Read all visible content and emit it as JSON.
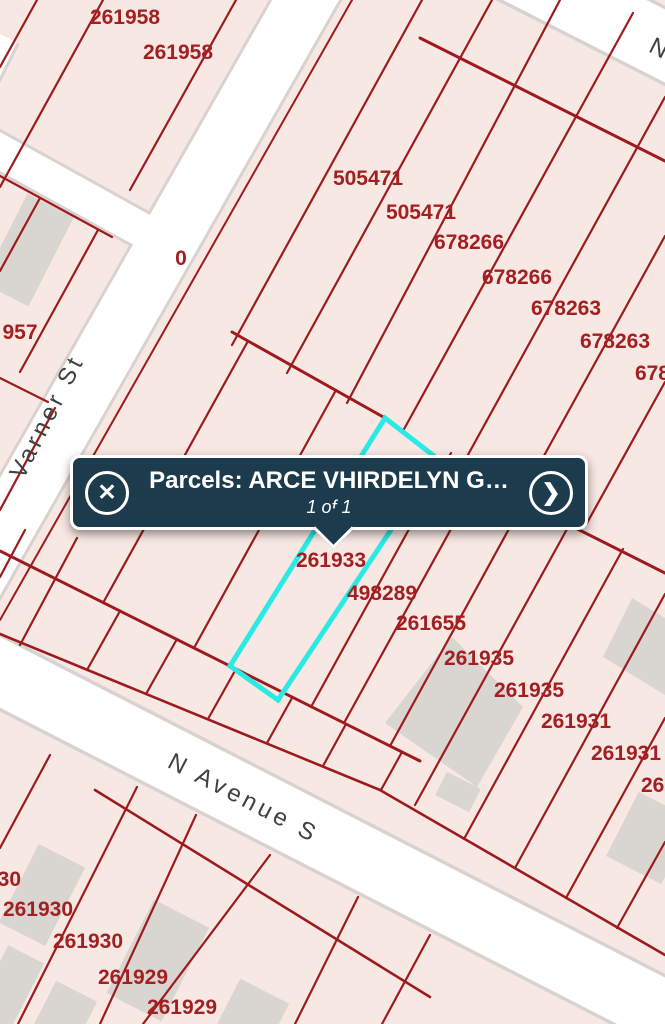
{
  "map": {
    "background_color": "#f8e8e4",
    "parcel_line_color": "#9d1b1e",
    "parcel_label_color": "#a32022",
    "highlight_color": "#2be9e3",
    "street_fill": "#ffffff",
    "street_casing": "#d8d3d0",
    "building_fill": "#d9d5d0",
    "street_label_color": "#3f4040",
    "parcel_labels": [
      {
        "text": "261958",
        "x": 125,
        "y": 24
      },
      {
        "text": "261958",
        "x": 178,
        "y": 59
      },
      {
        "text": "0",
        "x": 181,
        "y": 265
      },
      {
        "text": "957",
        "x": 20,
        "y": 339
      },
      {
        "text": "505471",
        "x": 368,
        "y": 185
      },
      {
        "text": "505471",
        "x": 421,
        "y": 219
      },
      {
        "text": "678266",
        "x": 469,
        "y": 249
      },
      {
        "text": "678266",
        "x": 517,
        "y": 284
      },
      {
        "text": "678263",
        "x": 566,
        "y": 315
      },
      {
        "text": "678263",
        "x": 615,
        "y": 348
      },
      {
        "text": "678263",
        "x": 670,
        "y": 380
      },
      {
        "text": "261933",
        "x": 331,
        "y": 567
      },
      {
        "text": "498289",
        "x": 382,
        "y": 600
      },
      {
        "text": "261655",
        "x": 431,
        "y": 630
      },
      {
        "text": "261935",
        "x": 479,
        "y": 665
      },
      {
        "text": "261935",
        "x": 529,
        "y": 697
      },
      {
        "text": "261931",
        "x": 576,
        "y": 728
      },
      {
        "text": "261931",
        "x": 626,
        "y": 760
      },
      {
        "text": "261931",
        "x": 676,
        "y": 792
      },
      {
        "text": "261930",
        "x": -14,
        "y": 886
      },
      {
        "text": "261930",
        "x": 38,
        "y": 916
      },
      {
        "text": "261930",
        "x": 88,
        "y": 948
      },
      {
        "text": "261929",
        "x": 133,
        "y": 984
      },
      {
        "text": "261929",
        "x": 182,
        "y": 1014
      }
    ],
    "street_labels": [
      {
        "text": "Varner St",
        "x": 54,
        "y": 420,
        "rotate": -63
      },
      {
        "text": "N Avenue S",
        "x": 240,
        "y": 805,
        "rotate": 27.5
      },
      {
        "text": "N",
        "x": 657,
        "y": 56,
        "rotate": 27
      }
    ]
  },
  "popup": {
    "title": "Parcels: ARCE VHIRDELYN G…",
    "pager": "1 of 1",
    "background": "#1c3b4d",
    "border_color": "#ffffff",
    "close_icon": "✕",
    "next_icon": "❯"
  }
}
